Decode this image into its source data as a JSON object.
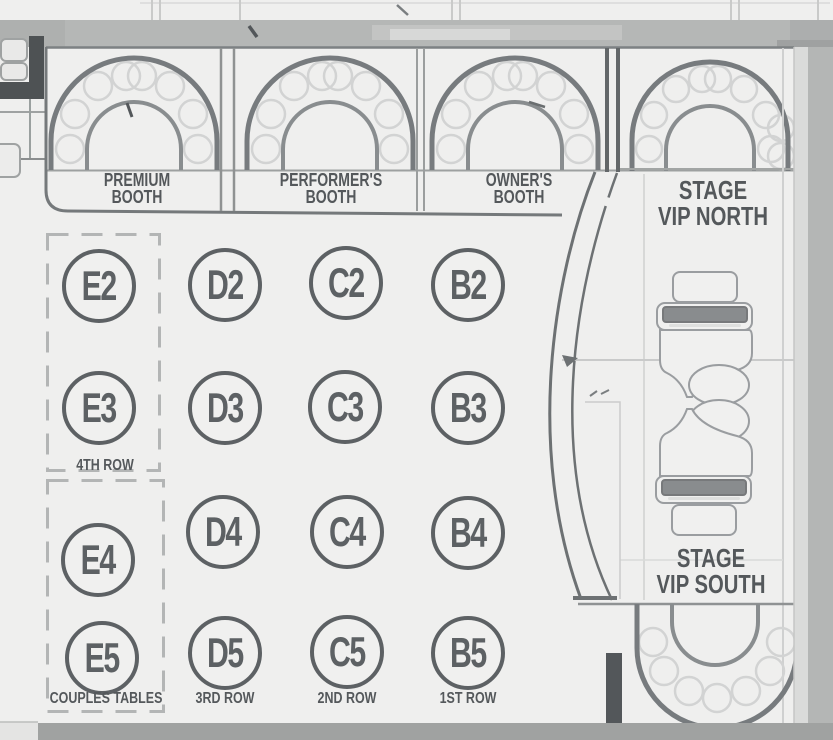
{
  "palette": {
    "floor": "#efefee",
    "ink": "#54585b",
    "table_stroke": "#5d6164",
    "arch_stroke": "#777b7e",
    "inner_arch_stroke": "#898d8f",
    "seat_stroke": "#d2d3d3",
    "wall_band": "#b5b7b6",
    "right_wall": "#b4b6b5",
    "bottom_bar": "#a0a2a1",
    "dark_fixture": "#4e5254",
    "dashed_zone": "#b3b5b5",
    "furniture_stroke": "#9a9da0",
    "sofa_bar": "#898c8e",
    "stage_edge": "#6d7173"
  },
  "booth_labels": {
    "premium": {
      "line1": "PREMIUM",
      "line2": "BOOTH"
    },
    "performers": {
      "line1": "PERFORMER'S",
      "line2": "BOOTH"
    },
    "owners": {
      "line1": "OWNER'S",
      "line2": "BOOTH"
    }
  },
  "vip_labels": {
    "north": {
      "line1": "STAGE",
      "line2": "VIP NORTH"
    },
    "south": {
      "line1": "STAGE",
      "line2": "VIP SOUTH"
    }
  },
  "tables": {
    "E2": "E2",
    "D2": "D2",
    "C2": "C2",
    "B2": "B2",
    "E3": "E3",
    "D3": "D3",
    "C3": "C3",
    "B3": "B3",
    "E4": "E4",
    "D4": "D4",
    "C4": "C4",
    "B4": "B4",
    "E5": "E5",
    "D5": "D5",
    "C5": "C5",
    "B5": "B5"
  },
  "row_labels": {
    "row4": "4TH ROW",
    "couples": "COUPLES TABLES",
    "row3": "3RD ROW",
    "row2": "2ND ROW",
    "row1": "1ST ROW"
  }
}
